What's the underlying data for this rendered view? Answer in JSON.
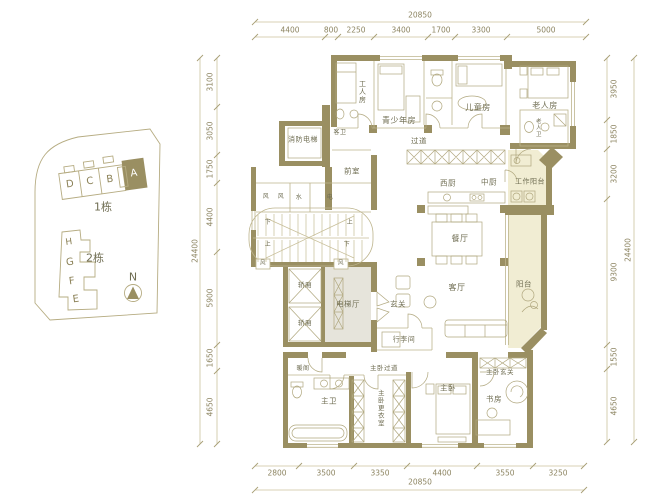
{
  "title": "apartment-floor-plan",
  "dims": {
    "top": {
      "total": "20850",
      "segments": [
        "4400",
        "800",
        "2250",
        "3400",
        "1700",
        "3300",
        "5000"
      ]
    },
    "bottom": {
      "total": "20850",
      "segments": [
        "2800",
        "3500",
        "3350",
        "4400",
        "3550",
        "3250"
      ]
    },
    "left": {
      "total": "24400",
      "segments": [
        "3100",
        "3050",
        "1750",
        "4400",
        "5900",
        "1650",
        "4650"
      ]
    },
    "right": {
      "total": "24400",
      "segments": [
        "3950",
        "1850",
        "3200",
        "9300",
        "1550",
        "4650"
      ]
    }
  },
  "keyplan": {
    "building1": {
      "label": "1栋",
      "units": [
        "D",
        "C",
        "B",
        "A"
      ],
      "highlighted_unit": "A"
    },
    "building2": {
      "label": "2栋",
      "units": [
        "H",
        "G",
        "F",
        "E"
      ]
    },
    "north_label": "N"
  },
  "rooms": {
    "fire_elevator": "消防电梯",
    "worker": "工人房",
    "guest_bath": "客卫",
    "teen": "青少年房",
    "kids": "儿童房",
    "elder": "老人房",
    "elder_bath": "老人卫",
    "corridor": "过道",
    "anteroom": "前室",
    "west_kitchen": "西厨",
    "mid_kitchen": "中厨",
    "work_balcony": "工作阳台",
    "dining": "餐厅",
    "elevator_hall": "电梯厅",
    "car": "轿厢",
    "foyer": "玄关",
    "living": "客厅",
    "balcony": "阳台",
    "luggage": "行李间",
    "master_corridor": "主卧过道",
    "nook": "暖阁",
    "master_bath": "主卫",
    "master_closet": "主卧更衣室",
    "master": "主卧",
    "master_foyer": "主卧玄关",
    "study": "书房",
    "wind": "风",
    "water": "水",
    "elec": "电",
    "up": "上",
    "down": "下"
  },
  "colors": {
    "wall": "#9a8f62",
    "thin_line": "#bdb48c",
    "balcony_fill": "#f1edd3",
    "hall_fill": "#e6e4db",
    "label_text": "#6f6d52",
    "dim_text": "#8d8562"
  }
}
